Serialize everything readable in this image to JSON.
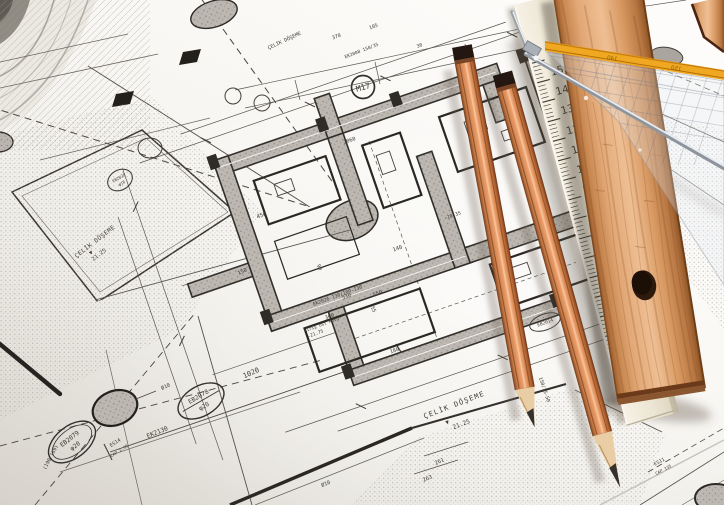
{
  "colors": {
    "paper": "#f6f4ef",
    "ink_line": "#3a3733",
    "wall_fill": "#bcb8b1",
    "ruler_wood": "#d99a63",
    "pencil_wood": "#d8855a",
    "graphite": "#35302b",
    "set_square_stripe": "#f0a722",
    "ivory_ruler": "#ece5d3",
    "metal": "#c9ccd2"
  },
  "blueprint": {
    "labels": {
      "m17": "M17",
      "celik_doseme": "ÇELİK DÖŞEME",
      "level_mark": "▼",
      "level_2125": "21.25",
      "kiris_ust": "Kiriş Üst Kotu",
      "level_2175": "-21.75",
      "ek2130": "EK2130",
      "es14": "ES14",
      "cap_135": "CAP 1.35",
      "eb2079": "EB2079",
      "eb2078": "EB2078",
      "eb2028": "EB2028",
      "eb2014": "EB2014",
      "phi20": "φ20",
      "phi16": "φ16",
      "ek2008": "EK2008 150/35",
      "ek2026": "EK2026 130/100-130",
      "es11": "ES11",
      "cap_135b": "CAP 135",
      "ratio": "150/35-50",
      "coords": "(190/169)",
      "dia10": "Ø10"
    },
    "dims": {
      "d450": "450",
      "d150": "150",
      "d90": "90",
      "d140": "140",
      "d550": "550",
      "d530": "530",
      "d360": "360",
      "d1020": "1020",
      "d2060": "2060",
      "d180": "180",
      "d55": "55",
      "d261": "261",
      "d263": "263",
      "d105": "105",
      "d370": "370",
      "d30": "30",
      "neg2035": "-20.35"
    }
  },
  "tools": {
    "scale_ruler": {
      "numbers": [
        "0",
        "1",
        "2",
        "3",
        "4",
        "5",
        "6",
        "7",
        "8",
        "9",
        "10",
        "11",
        "12",
        "13",
        "14",
        "15"
      ]
    },
    "set_square": {
      "stripe_numbers": [
        "140",
        "150"
      ]
    }
  }
}
